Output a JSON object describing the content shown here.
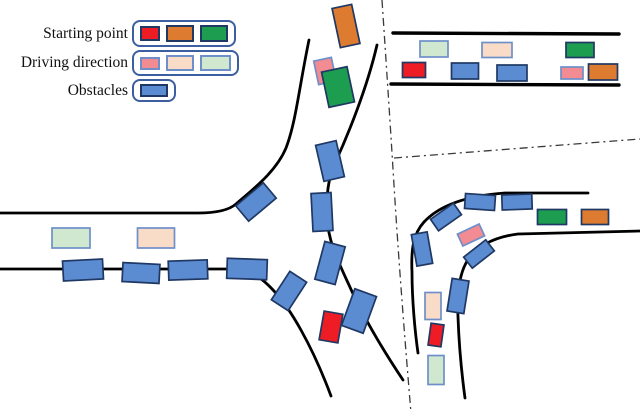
{
  "figure": {
    "background": "#FFFFFF",
    "palette": {
      "red": "#EE1C25",
      "orange": "#DD7B30",
      "green": "#1D9D50",
      "pink": "#F28B92",
      "peach": "#F8DCC8",
      "light_green": "#CFE8CF",
      "blue": "#5B8BD0",
      "dark_border": "#1F3864",
      "light_border": "#6E8FC9",
      "road": "#000000",
      "separator": "#3A3A3A"
    },
    "legend": {
      "rows": [
        {
          "id": "starting-point",
          "label": "Starting point",
          "swatches": [
            {
              "name": "red",
              "color": "#EE1C25",
              "border": "#1F3864",
              "w": 20,
              "h": 15
            },
            {
              "name": "orange",
              "color": "#DD7B30",
              "border": "#1F3864",
              "w": 28,
              "h": 17
            },
            {
              "name": "green",
              "color": "#1D9D50",
              "border": "#1F3864",
              "w": 28,
              "h": 17
            }
          ]
        },
        {
          "id": "driving-direction",
          "label": "Driving direction",
          "swatches": [
            {
              "name": "pink",
              "color": "#F28B92",
              "border": "#6E8FC9",
              "w": 20,
              "h": 13
            },
            {
              "name": "peach",
              "color": "#F8DCC8",
              "border": "#6E8FC9",
              "w": 28,
              "h": 16
            },
            {
              "name": "light-green",
              "color": "#CFE8CF",
              "border": "#6E8FC9",
              "w": 31,
              "h": 16
            }
          ]
        },
        {
          "id": "obstacles",
          "label": "Obstacles",
          "swatches": [
            {
              "name": "blue",
              "color": "#5B8BD0",
              "border": "#1F3864",
              "w": 28,
              "h": 13
            }
          ]
        }
      ]
    },
    "roads": [
      {
        "name": "road-edge-top-left-merge",
        "sw": 2.8,
        "d": "M 309 40 C 299 88 296 122 286 148 C 276 172 252 190 236 204 C 228 211 214 213 198 213 L 0 213"
      },
      {
        "name": "road-edge-center-right",
        "sw": 2.8,
        "d": "M 377 45 C 367 88 348 135 335 163 C 328 178 326 198 327 216 C 328 241 337 259 349 285 C 361 312 381 347 403 380"
      },
      {
        "name": "road-edge-bottom-left-merge",
        "sw": 2.8,
        "d": "M 0 269 L 228 269 C 252 269 263 279 274 291 C 290 308 312 345 331 396"
      },
      {
        "name": "road-edge-topright-upper",
        "sw": 3.4,
        "d": "M 393 33 L 619 34"
      },
      {
        "name": "road-edge-topright-lower",
        "sw": 3.4,
        "d": "M 391 84 L 619 85"
      },
      {
        "name": "road-edge-corner-outer",
        "sw": 2.8,
        "d": "M 588 193 L 505 193 C 462 196 438 207 424 222 C 413 234 411 250 412 272 C 412 300 415 332 418 353"
      },
      {
        "name": "road-edge-corner-inner",
        "sw": 2.8,
        "d": "M 640 231 L 518 234 C 494 237 474 247 466 263 C 459 276 457 295 458 317 C 459 345 462 376 465 398"
      }
    ],
    "separators": [
      {
        "name": "scenario-separator-vertical",
        "d": "M 382 0 C 386 60 390 120 394 185 C 398 250 404 330 411 413"
      },
      {
        "name": "scenario-separator-horizontal",
        "d": "M 394 158 L 640 139"
      }
    ],
    "vehicles": [
      {
        "cx": 346,
        "cy": 26,
        "w": 20,
        "h": 40,
        "rot": -12,
        "color": "orange"
      },
      {
        "cx": 325,
        "cy": 71,
        "w": 18,
        "h": 24,
        "rot": -12,
        "color": "pink"
      },
      {
        "cx": 338,
        "cy": 87,
        "w": 26,
        "h": 36,
        "rot": -12,
        "color": "green"
      },
      {
        "cx": 330,
        "cy": 161,
        "w": 21,
        "h": 37,
        "rot": -13,
        "color": "blue"
      },
      {
        "cx": 322,
        "cy": 212,
        "w": 20,
        "h": 38,
        "rot": -3,
        "color": "blue"
      },
      {
        "cx": 330,
        "cy": 263,
        "w": 21,
        "h": 39,
        "rot": 15,
        "color": "blue"
      },
      {
        "cx": 256,
        "cy": 202,
        "w": 36,
        "h": 20,
        "rot": -40,
        "color": "blue"
      },
      {
        "cx": 289,
        "cy": 291,
        "w": 20,
        "h": 34,
        "rot": 33,
        "color": "blue"
      },
      {
        "cx": 359,
        "cy": 311,
        "w": 23,
        "h": 39,
        "rot": 20,
        "color": "blue"
      },
      {
        "cx": 331,
        "cy": 327,
        "w": 19,
        "h": 29,
        "rot": 10,
        "color": "red"
      },
      {
        "cx": 71,
        "cy": 238,
        "w": 38,
        "h": 20,
        "rot": 0,
        "color": "light_green"
      },
      {
        "cx": 156,
        "cy": 238,
        "w": 37,
        "h": 20,
        "rot": 0,
        "color": "peach"
      },
      {
        "cx": 83,
        "cy": 270,
        "w": 40,
        "h": 20,
        "rot": -3,
        "color": "blue"
      },
      {
        "cx": 141,
        "cy": 273,
        "w": 37,
        "h": 19,
        "rot": 3,
        "color": "blue"
      },
      {
        "cx": 188,
        "cy": 270,
        "w": 39,
        "h": 19,
        "rot": -2,
        "color": "blue"
      },
      {
        "cx": 247,
        "cy": 269,
        "w": 40,
        "h": 20,
        "rot": 2,
        "color": "blue"
      },
      {
        "cx": 434,
        "cy": 49,
        "w": 28,
        "h": 16,
        "rot": 0,
        "color": "light_green"
      },
      {
        "cx": 497,
        "cy": 50,
        "w": 30,
        "h": 15,
        "rot": 0,
        "color": "peach"
      },
      {
        "cx": 580,
        "cy": 50,
        "w": 28,
        "h": 15,
        "rot": 0,
        "color": "green"
      },
      {
        "cx": 414,
        "cy": 70,
        "w": 23,
        "h": 15,
        "rot": 0,
        "color": "red"
      },
      {
        "cx": 465,
        "cy": 71,
        "w": 27,
        "h": 16,
        "rot": 0,
        "color": "blue"
      },
      {
        "cx": 512,
        "cy": 73,
        "w": 30,
        "h": 16,
        "rot": 0,
        "color": "blue"
      },
      {
        "cx": 572,
        "cy": 73,
        "w": 22,
        "h": 12,
        "rot": 0,
        "color": "pink"
      },
      {
        "cx": 603,
        "cy": 72,
        "w": 29,
        "h": 16,
        "rot": 0,
        "color": "orange"
      },
      {
        "cx": 480,
        "cy": 202,
        "w": 30,
        "h": 15,
        "rot": 4,
        "color": "blue"
      },
      {
        "cx": 517,
        "cy": 202,
        "w": 30,
        "h": 15,
        "rot": -2,
        "color": "blue"
      },
      {
        "cx": 446,
        "cy": 217,
        "w": 28,
        "h": 14,
        "rot": -35,
        "color": "blue"
      },
      {
        "cx": 471,
        "cy": 235,
        "w": 24,
        "h": 13,
        "rot": -25,
        "color": "pink"
      },
      {
        "cx": 552,
        "cy": 217,
        "w": 29,
        "h": 15,
        "rot": 0,
        "color": "green"
      },
      {
        "cx": 595,
        "cy": 217,
        "w": 27,
        "h": 15,
        "rot": 0,
        "color": "orange"
      },
      {
        "cx": 422,
        "cy": 249,
        "w": 16,
        "h": 32,
        "rot": -10,
        "color": "blue"
      },
      {
        "cx": 479,
        "cy": 254,
        "w": 28,
        "h": 14,
        "rot": -38,
        "color": "blue"
      },
      {
        "cx": 458,
        "cy": 296,
        "w": 17,
        "h": 33,
        "rot": 9,
        "color": "blue"
      },
      {
        "cx": 433,
        "cy": 306,
        "w": 16,
        "h": 27,
        "rot": 0,
        "color": "peach"
      },
      {
        "cx": 436,
        "cy": 335,
        "w": 13,
        "h": 22,
        "rot": 8,
        "color": "red"
      },
      {
        "cx": 436,
        "cy": 370,
        "w": 16,
        "h": 29,
        "rot": 0,
        "color": "light_green"
      }
    ]
  }
}
